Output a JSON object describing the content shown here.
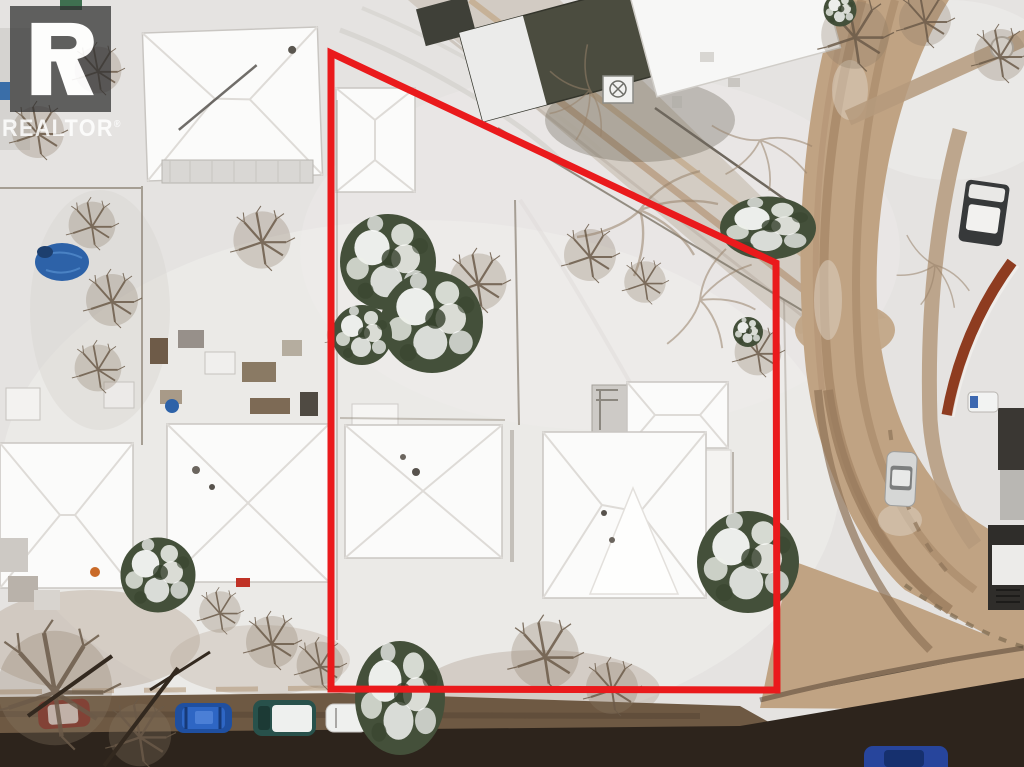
{
  "watermark": {
    "brand": "REALTOR",
    "registered": "®"
  },
  "boundary": {
    "points": "331,53 776,263 777,690 331,689",
    "color": "#ea1a1c",
    "stroke_width": "7"
  },
  "palette": {
    "snow": "#e5e3e1",
    "snow_bright": "#f4f3f1",
    "snow_shadow": "#d2cfcb",
    "roof_snow": "#fbfbfa",
    "roof_edge": "#c6c3bf",
    "road_dirt": "#c0a383",
    "road_track": "#a5876a",
    "sidewalk": "#b59a7c",
    "alley_slush": "#cfc7bd",
    "street_asphalt": "#2d241c",
    "street_dirt": "#6e5943",
    "building_olive": "#4b4c3f",
    "building_dark": "#3a3733",
    "evergreen": "#44503a",
    "bare_branch": "#6b5b49",
    "rust_wall": "#8e3c20",
    "deck_gray": "#d9d7d4"
  },
  "vehicles": {
    "blue_car": "#1f4fa0",
    "teal_car": "#28514b",
    "red_car": "#7e2a22",
    "white_car": "#eff0ee",
    "silver_car": "#d6d7d6",
    "pickup_truck": "#37393a",
    "street_car_blue": "#27459c",
    "van_white": "#f2f3f2",
    "tarp_blue": "#2d62a8"
  }
}
